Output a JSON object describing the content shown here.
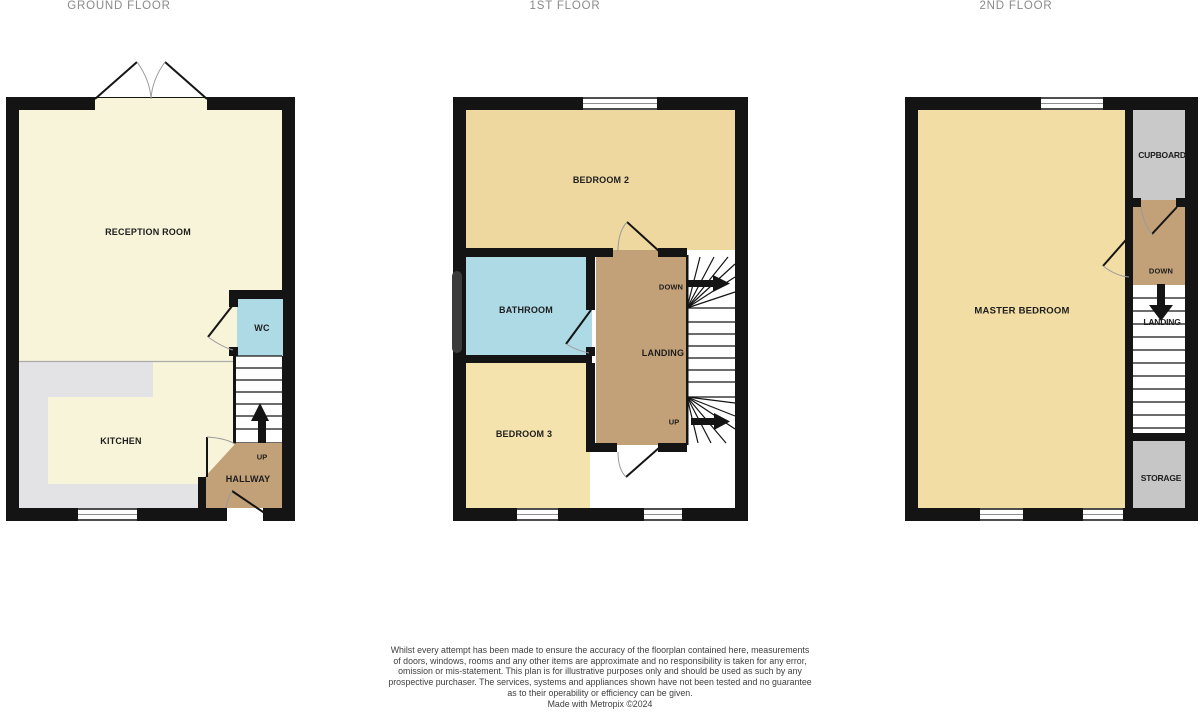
{
  "titles": {
    "ground": "GROUND FLOOR",
    "first": "1ST FLOOR",
    "second": "2ND FLOOR"
  },
  "ground_floor": {
    "reception": "RECEPTION ROOM",
    "kitchen": "KITCHEN",
    "wc": "WC",
    "hallway": "HALLWAY",
    "up": "UP"
  },
  "first_floor": {
    "bedroom2": "BEDROOM 2",
    "bathroom": "BATHROOM",
    "bedroom3": "BEDROOM 3",
    "landing": "LANDING",
    "down": "DOWN",
    "up": "UP"
  },
  "second_floor": {
    "master": "MASTER BEDROOM",
    "cupboard": "CUPBOARD",
    "landing": "LANDING",
    "storage": "STORAGE",
    "down": "DOWN"
  },
  "colors": {
    "wall": "#141414",
    "cream": "#f8f4da",
    "counter_gray": "#e3e3e6",
    "blue": "#aedae6",
    "tan": "#c2a078",
    "golden": "#efd8a0",
    "golden_light": "#f5e3ae",
    "master_gold": "#f2dda5",
    "cupboard_gray": "#c9c9c9",
    "storage_gray": "#c6c6c6",
    "arc_gray": "#9a9a9a",
    "stair_white": "#ffffff",
    "radiator": "#3c3c3c"
  },
  "disclaimer": {
    "lines": [
      "Whilst every attempt has been made to ensure the accuracy of the floorplan contained here, measurements",
      "of doors, windows, rooms and any other items are approximate and no responsibility is taken for any error,",
      "omission or mis-statement. This plan is for illustrative purposes only and should be used as such by any",
      "prospective purchaser. The services, systems and appliances shown have not been tested and no guarantee",
      "as to their operability or efficiency can be given.",
      "Made with Metropix ©2024"
    ]
  }
}
